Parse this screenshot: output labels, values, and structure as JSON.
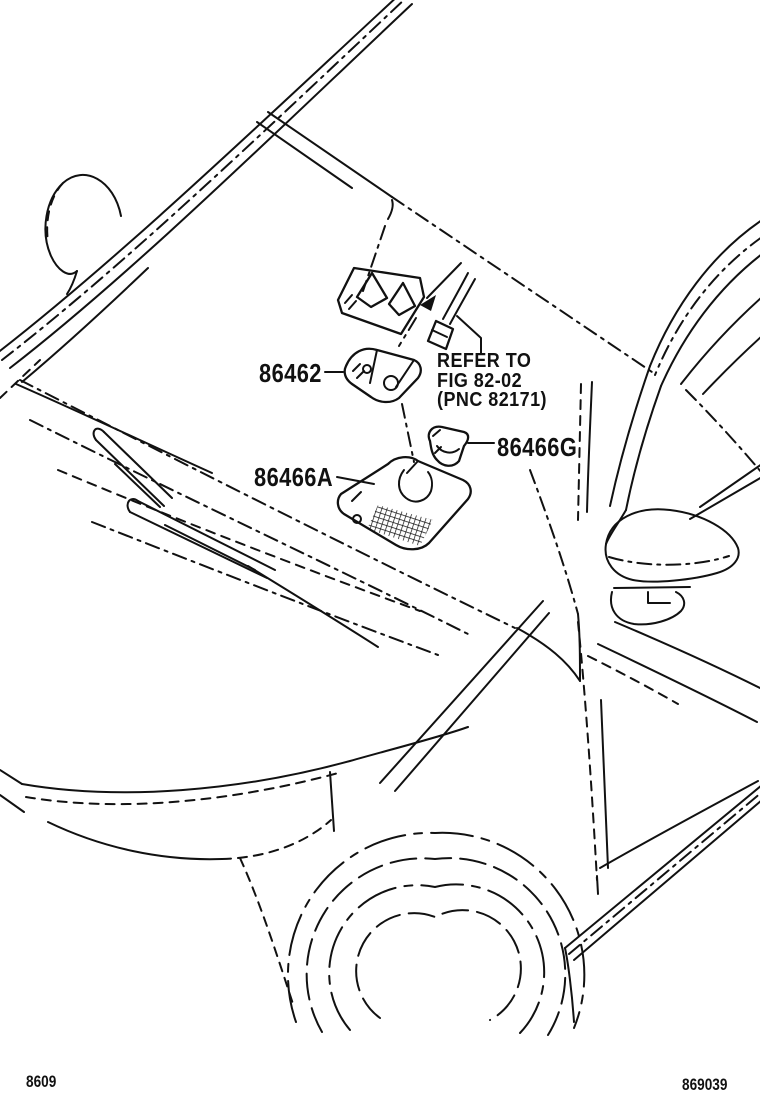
{
  "figure": {
    "background_color": "#ffffff",
    "line_color": "#111111",
    "parts": [
      {
        "label": "86462"
      },
      {
        "label": "86466A"
      },
      {
        "label": "86466G"
      }
    ],
    "note": {
      "lines": [
        "REFER TO",
        "FIG 82-02",
        "(PNC 82171)"
      ]
    },
    "footer": {
      "left_code": "8609",
      "right_code": "869039"
    }
  }
}
